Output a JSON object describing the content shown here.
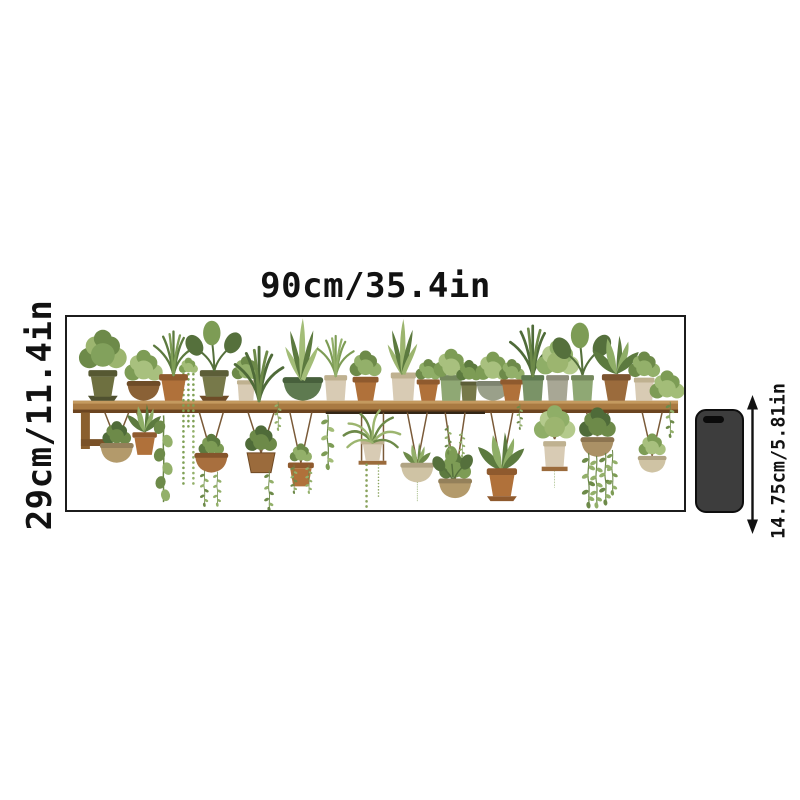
{
  "labels": {
    "width": "90cm/35.4in",
    "height": "29cm/11.4in",
    "phone_height": "14.75cm/5.81in"
  },
  "artwork": {
    "name": "watercolor-plant-shelf-wall-decal",
    "description": "Wooden shelf lined with potted green plants on top and hanging planters with trailing vines below",
    "frame_color": "#1c1c1c",
    "background": "#ffffff"
  },
  "phone": {
    "body_color": "#3d3d3d",
    "outline_color": "#0e0e0e",
    "camera_style": "pill-top-left"
  },
  "palette": {
    "leaf_dark": "#5c7a3f",
    "leaf_mid": "#7d9c55",
    "leaf_light": "#a3bd78",
    "terracotta": "#b0713a",
    "olive_pot": "#6e7040",
    "cream_pot": "#d8cbb4",
    "sage_pot": "#8fa874",
    "wood_shelf": "#a97a42",
    "wood_dark": "#6b4420",
    "rope": "#7a5a38",
    "text": "#121212"
  }
}
